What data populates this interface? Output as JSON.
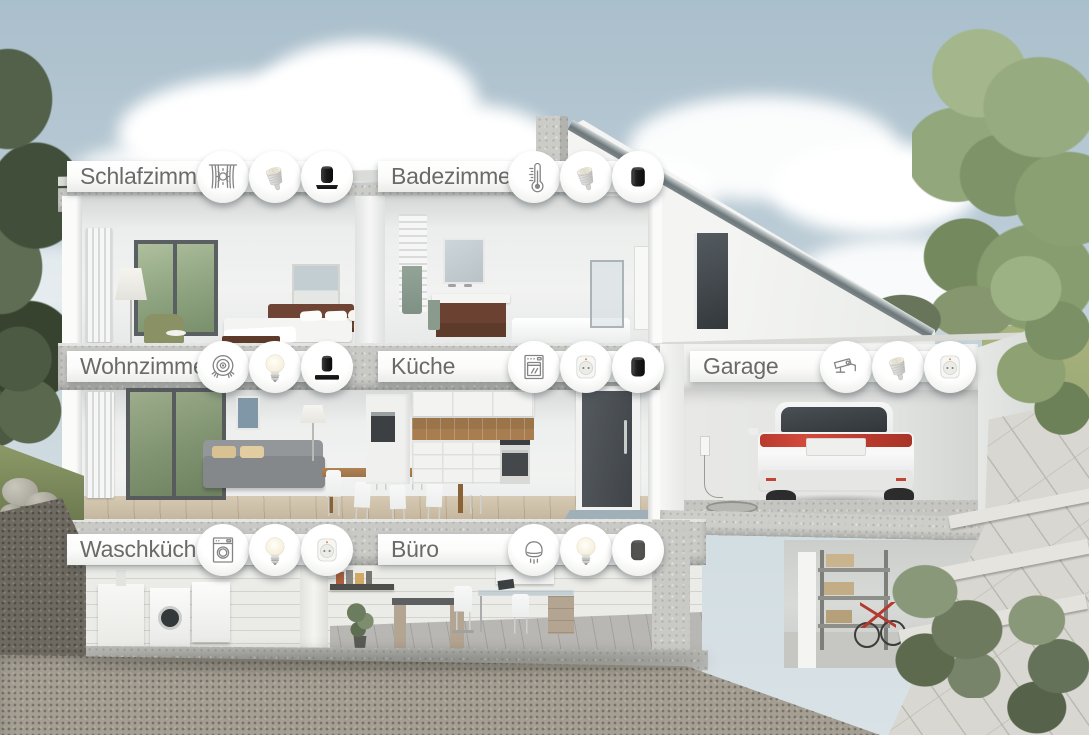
{
  "title": "Smart Home Haus-Querschnitt",
  "colors": {
    "label_bar": "#ffffff",
    "label_text": "#6a6a6a",
    "icon_line": "#848484",
    "sky_top": "#adc2ce",
    "car_accent_red": "#b93a2e"
  },
  "rooms": [
    {
      "id": "schlafzimmer",
      "name": "Schlafzimmer",
      "icons": [
        "blinds-icon",
        "gu10-bulb-icon",
        "smart-speaker-base-icon"
      ]
    },
    {
      "id": "badezimmer",
      "name": "Badezimmer",
      "icons": [
        "thermometer-icon",
        "gu10-bulb-icon",
        "smart-speaker-icon"
      ]
    },
    {
      "id": "wohnzimmer",
      "name": "Wohnzimmer",
      "icons": [
        "robot-vacuum-icon",
        "e27-bulb-icon",
        "smart-speaker-soundbar-icon"
      ]
    },
    {
      "id": "kueche",
      "name": "Küche",
      "icons": [
        "oven-icon",
        "smart-plug-icon",
        "smart-speaker-icon"
      ]
    },
    {
      "id": "garage",
      "name": "Garage",
      "icons": [
        "security-camera-icon",
        "gu10-bulb-icon",
        "smart-plug-icon"
      ]
    },
    {
      "id": "waschkueche",
      "name": "Waschküche",
      "icons": [
        "washing-machine-icon",
        "e27-bulb-icon",
        "smart-plug-icon"
      ]
    },
    {
      "id": "buero",
      "name": "Büro",
      "icons": [
        "heater-icon",
        "e27-bulb-icon",
        "smart-speaker-fabric-icon"
      ]
    }
  ]
}
